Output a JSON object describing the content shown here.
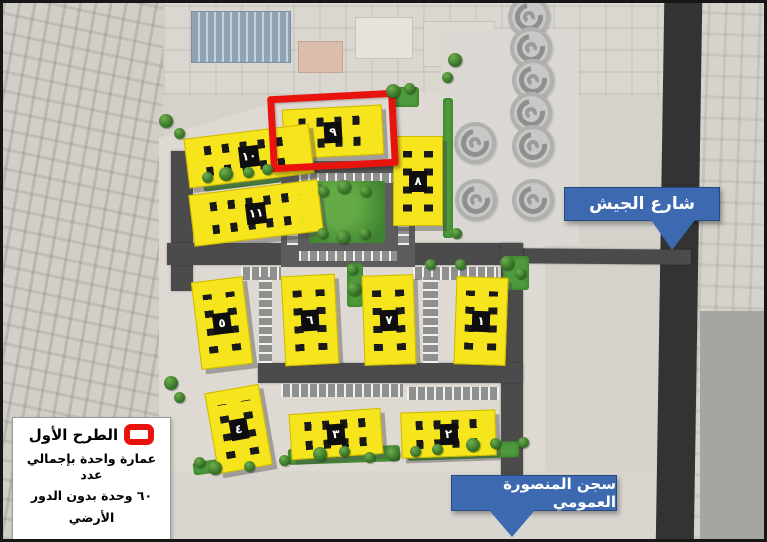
{
  "map": {
    "street_label": "شارع الجيش",
    "prison_label": "سجن المنصورة العمومي"
  },
  "legend": {
    "title": "الطرح الأول",
    "line1": "عمارة واحدة بإجمالي عدد",
    "line2": "٦٠ وحدة بدون  الدور",
    "line3": "الأرضي",
    "marker_icon": "red-rectangle-outline"
  },
  "buildings": [
    {
      "id": 1,
      "number": "١"
    },
    {
      "id": 2,
      "number": "٢"
    },
    {
      "id": 3,
      "number": "٣"
    },
    {
      "id": 4,
      "number": "٤"
    },
    {
      "id": 5,
      "number": "٥"
    },
    {
      "id": 6,
      "number": "٦"
    },
    {
      "id": 7,
      "number": "٧"
    },
    {
      "id": 8,
      "number": "٨"
    },
    {
      "id": 9,
      "number": "٩",
      "highlighted": true
    },
    {
      "id": 10,
      "number": "١٠"
    },
    {
      "id": 11,
      "number": "١١"
    }
  ],
  "highlighted_building": "٩",
  "colors": {
    "building_fill": "#f6e51d",
    "highlight_red": "#e8130d",
    "callout_blue": "#3c69b0",
    "road_dark": "#4b4b4b",
    "green": "#4e9a3c"
  }
}
